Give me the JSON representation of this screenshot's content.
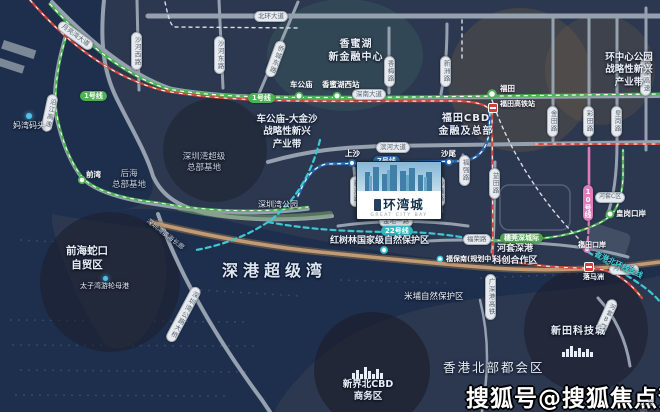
{
  "map": {
    "project": {
      "name": "环湾城",
      "name_en": "GREAT CITY BAY"
    },
    "watermark": {
      "text": "搜狐号@搜狐焦点贺州站",
      "note": "示意图"
    },
    "colors": {
      "land": "#2b3850",
      "water": "#1e2f4d",
      "coast_sand": "#c29b74",
      "line1_green": "#4db253",
      "line7_blue": "#2a66ad",
      "line22_cyan": "#3cc9d4",
      "line10_pink": "#df7cbc",
      "hsr_red": "#d2493f",
      "road_gray": "#96a1af"
    },
    "metro_labels": {
      "line1": "1号线",
      "line7": "7号线",
      "line22": "22号线",
      "line10": "10号线",
      "intercity": "穗莞深城际",
      "hk_link": "香港北环线支线"
    },
    "roads": {
      "beihuan": "北环大道",
      "shennan": "深南大道",
      "binhe": "滨河大道",
      "furong": "福荣路",
      "jindi1": "金地一路",
      "shahexi": "沙河西路",
      "shahedong": "沙河东路",
      "qiaochengdong": "侨城东路",
      "yueliangwan": "月亮湾大道",
      "xiangmei": "香梅路",
      "xinzhou": "新洲路",
      "yitian": "益田路",
      "jintian": "金田路",
      "caitian": "彩田路",
      "huanggang": "皇岗路",
      "guangshen_expwy": "广深高速",
      "yanjiang_expwy": "沿江高速",
      "shazui": "沙嘴路",
      "fuqiang": "福强路",
      "szbay_bridge": "深圳湾公路大桥",
      "hsr": "广深港高铁"
    },
    "stations": {
      "chegongmiao": "车公庙",
      "xiangmihuxi": "香蜜湖西站",
      "futian": "福田",
      "futian_hsr": "福田高铁站",
      "qianwan": "前湾",
      "shangsha": "上沙",
      "shawei": "沙尾",
      "fubaonan": "福保南(规划中)",
      "futian_port": "福田口岸",
      "huanggang_port": "皇岗口岸",
      "luomazhou": "落马洲"
    },
    "areas": {
      "xiangmihu": "香蜜湖\n新金融中心",
      "huanzhongxin": "环中心公园\n战略性新兴\n产业带",
      "chegongmiao_dajinsha": "车公庙-大金沙\n战略性新兴\n产业带",
      "futian_cbd": "福田CBD\n金融及总部",
      "szw_hq": "深圳湾超级\n总部基地",
      "houhai": "后海\n总部基地",
      "mawan": "妈湾码头",
      "qianhai": "前海蛇口\n自贸区",
      "taiziwan": "太子湾游轮母港",
      "szw_park": "深圳湾公园",
      "szw_promenade": "深圳湾滨海长廊",
      "hongshulin": "红树林国家级自然保护区",
      "shengang_bay": "深港超级湾",
      "mipu": "米埔自然保护区",
      "hk_metropolis": "香港北部都会区",
      "xinjiebei": "新界北CBD\n商务区",
      "xintian": "新田科技城",
      "hetao": "河套深港\n科创合作区",
      "hetao_a": "河套A区",
      "hetao_b": "河套B区",
      "hetao_c": "河套C区"
    }
  }
}
